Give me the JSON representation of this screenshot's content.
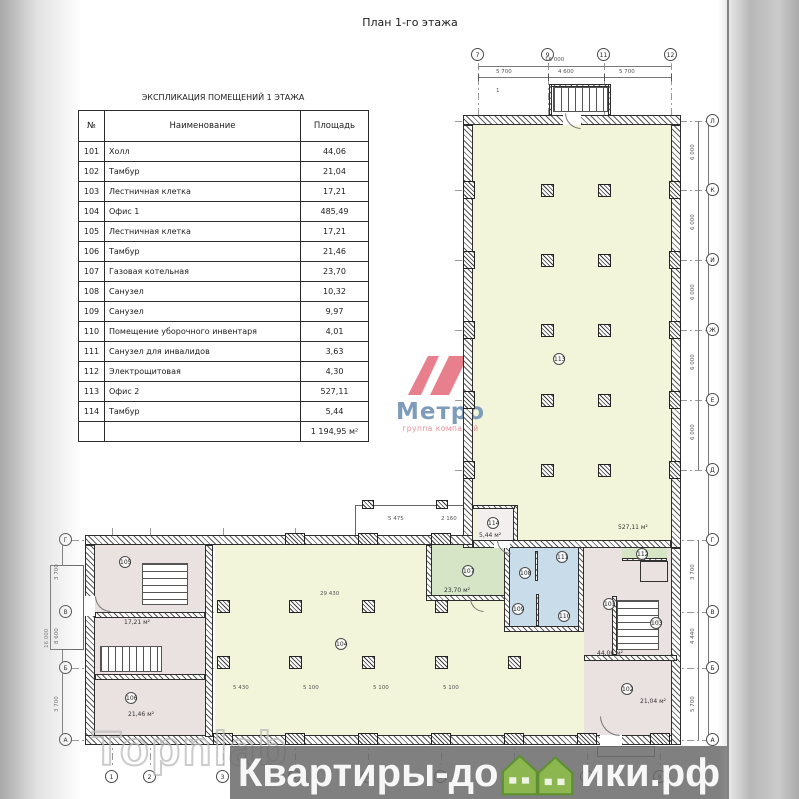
{
  "page": {
    "title": "План 1-го этажа"
  },
  "table": {
    "title": "ЭКСПЛИКАЦИЯ ПОМЕЩЕНИЙ 1 ЭТАЖА",
    "columns": [
      "№",
      "Наименование",
      "Площадь"
    ],
    "rows": [
      [
        "101",
        "Холл",
        "44,06"
      ],
      [
        "102",
        "Тамбур",
        "21,04"
      ],
      [
        "103",
        "Лестничная клетка",
        "17,21"
      ],
      [
        "104",
        "Офис 1",
        "485,49"
      ],
      [
        "105",
        "Лестничная клетка",
        "17,21"
      ],
      [
        "106",
        "Тамбур",
        "21,46"
      ],
      [
        "107",
        "Газовая котельная",
        "23,70"
      ],
      [
        "108",
        "Санузел",
        "10,32"
      ],
      [
        "109",
        "Санузел",
        "9,97"
      ],
      [
        "110",
        "Помещение уборочного инвентаря",
        "4,01"
      ],
      [
        "111",
        "Санузел для инвалидов",
        "3,63"
      ],
      [
        "112",
        "Электрощитовая",
        "4,30"
      ],
      [
        "113",
        "Офис 2",
        "527,11"
      ],
      [
        "114",
        "Тамбур",
        "5,44"
      ]
    ],
    "total": "1 194,95 м²"
  },
  "logo": {
    "name": "Метро",
    "subtitle": "группа компаний",
    "colors": {
      "mark": "#e87f8d",
      "name": "#7e9cba",
      "subtitle": "#e8909b"
    }
  },
  "watermarks": {
    "topnlab": "Topnlab",
    "banner_left": "Квартиры-до",
    "banner_right": "ики.рф",
    "banner_house_color": "#8cb750"
  },
  "plan": {
    "colors": {
      "office": "#f3f5da",
      "wet": "#c9dcea",
      "boiler": "#d7e5c7",
      "circulation": "#eae1e1"
    },
    "walls": [
      [
        463,
        115,
        218,
        10
      ],
      [
        463,
        125,
        10,
        423
      ],
      [
        671,
        125,
        10,
        423
      ],
      [
        85,
        535,
        388,
        10
      ],
      [
        85,
        545,
        10,
        200
      ],
      [
        85,
        735,
        596,
        10
      ],
      [
        671,
        548,
        10,
        197
      ],
      [
        205,
        545,
        8,
        192
      ],
      [
        95,
        612,
        110,
        6
      ],
      [
        95,
        674,
        110,
        6
      ],
      [
        426,
        545,
        6,
        56
      ],
      [
        426,
        595,
        82,
        6
      ],
      [
        504,
        545,
        6,
        87
      ],
      [
        504,
        626,
        80,
        6
      ],
      [
        578,
        545,
        6,
        87
      ],
      [
        584,
        655,
        93,
        6
      ],
      [
        612,
        596,
        5,
        59
      ],
      [
        513,
        505,
        5,
        40
      ],
      [
        473,
        505,
        42,
        4
      ],
      [
        549,
        84,
        62,
        3
      ],
      [
        549,
        84,
        3,
        31
      ],
      [
        608,
        84,
        3,
        31
      ],
      [
        473,
        540,
        198,
        8
      ],
      [
        535,
        551,
        3,
        30
      ],
      [
        622,
        558,
        45,
        3
      ],
      [
        536,
        594,
        3,
        32
      ]
    ],
    "outlines": [
      [
        50,
        565,
        34,
        85
      ],
      [
        355,
        505,
        118,
        37
      ],
      [
        597,
        746,
        58,
        11
      ]
    ],
    "fills": [
      {
        "c": "fy",
        "r": [
          473,
          125,
          198,
          417
        ]
      },
      {
        "c": "fy",
        "r": [
          215,
          545,
          370,
          190
        ]
      },
      {
        "c": "fg",
        "r": [
          432,
          545,
          72,
          52
        ]
      },
      {
        "c": "fb",
        "r": [
          510,
          545,
          68,
          81
        ]
      },
      {
        "c": "fp",
        "r": [
          95,
          545,
          110,
          190
        ]
      },
      {
        "c": "fp",
        "r": [
          584,
          548,
          87,
          107
        ]
      },
      {
        "c": "fp",
        "r": [
          584,
          661,
          87,
          74
        ]
      },
      {
        "c": "fg",
        "r": [
          622,
          548,
          45,
          12
        ]
      },
      {
        "c": "fw",
        "r": [
          477,
          509,
          36,
          31
        ]
      }
    ],
    "stairs": [
      {
        "c": "stv",
        "r": [
          553,
          87,
          55,
          25
        ]
      },
      {
        "c": "sth",
        "r": [
          142,
          563,
          46,
          42
        ]
      },
      {
        "c": "stv",
        "r": [
          100,
          646,
          62,
          26
        ]
      },
      {
        "c": "sth",
        "r": [
          617,
          600,
          42,
          50
        ]
      }
    ],
    "elevator": [
      640,
      561,
      28,
      21
    ],
    "columns": [
      [
        541,
        184,
        13,
        13
      ],
      [
        598,
        184,
        13,
        13
      ],
      [
        541,
        254,
        13,
        13
      ],
      [
        598,
        254,
        13,
        13
      ],
      [
        541,
        324,
        13,
        13
      ],
      [
        598,
        324,
        13,
        13
      ],
      [
        541,
        394,
        13,
        13
      ],
      [
        598,
        394,
        13,
        13
      ],
      [
        541,
        464,
        13,
        13
      ],
      [
        598,
        464,
        13,
        13
      ],
      [
        217,
        600,
        13,
        13
      ],
      [
        289,
        600,
        13,
        13
      ],
      [
        362,
        600,
        13,
        13
      ],
      [
        435,
        600,
        13,
        13
      ],
      [
        217,
        656,
        13,
        13
      ],
      [
        289,
        656,
        13,
        13
      ],
      [
        362,
        656,
        13,
        13
      ],
      [
        435,
        656,
        13,
        13
      ],
      [
        508,
        656,
        13,
        13
      ],
      [
        362,
        500,
        12,
        9
      ],
      [
        436,
        500,
        12,
        9
      ]
    ],
    "pilasters": [
      [
        463,
        181,
        12,
        18
      ],
      [
        463,
        251,
        12,
        18
      ],
      [
        463,
        321,
        12,
        18
      ],
      [
        463,
        391,
        12,
        18
      ],
      [
        463,
        461,
        12,
        18
      ],
      [
        669,
        181,
        12,
        18
      ],
      [
        669,
        251,
        12,
        18
      ],
      [
        669,
        321,
        12,
        18
      ],
      [
        669,
        391,
        12,
        18
      ],
      [
        669,
        461,
        12,
        18
      ],
      [
        213,
        733,
        20,
        12
      ],
      [
        285,
        733,
        20,
        12
      ],
      [
        358,
        733,
        20,
        12
      ],
      [
        431,
        733,
        20,
        12
      ],
      [
        504,
        733,
        20,
        12
      ],
      [
        577,
        733,
        20,
        12
      ],
      [
        650,
        733,
        20,
        12
      ],
      [
        285,
        533,
        20,
        12
      ],
      [
        358,
        533,
        20,
        12
      ],
      [
        431,
        533,
        20,
        12
      ]
    ],
    "gaps": [
      [
        563,
        115,
        18,
        10
      ],
      [
        85,
        596,
        10,
        20
      ],
      [
        600,
        735,
        22,
        10
      ],
      [
        494,
        541,
        16,
        7
      ]
    ],
    "arcs": [
      [
        565,
        113,
        16,
        16
      ],
      [
        497,
        540,
        14,
        14
      ],
      [
        95,
        596,
        16,
        16
      ],
      [
        600,
        716,
        20,
        20
      ],
      [
        470,
        598,
        14,
        14
      ]
    ],
    "grid_v": [
      [
        478,
        48,
        512
      ],
      [
        548,
        48,
        512
      ],
      [
        604,
        48,
        512
      ],
      [
        671,
        48,
        512
      ],
      [
        112,
        528,
        240
      ],
      [
        150,
        528,
        240
      ],
      [
        223,
        528,
        240
      ],
      [
        295,
        528,
        240
      ],
      [
        368,
        528,
        240
      ],
      [
        441,
        528,
        240
      ],
      [
        514,
        528,
        240
      ],
      [
        587,
        528,
        240
      ],
      [
        660,
        528,
        240
      ]
    ],
    "grid_h": [
      [
        455,
        121,
        253
      ],
      [
        455,
        190,
        253
      ],
      [
        455,
        260,
        253
      ],
      [
        455,
        330,
        253
      ],
      [
        455,
        400,
        253
      ],
      [
        455,
        470,
        253
      ],
      [
        72,
        540,
        636
      ],
      [
        72,
        612,
        636
      ],
      [
        72,
        668,
        636
      ],
      [
        72,
        740,
        636
      ]
    ],
    "dim_h": [
      [
        478,
        66,
        193
      ],
      [
        478,
        77,
        193
      ]
    ],
    "dim_v": [
      [
        698,
        121,
        1,
        349
      ],
      [
        698,
        540,
        1,
        200
      ],
      [
        62,
        540,
        1,
        200
      ],
      [
        708,
        121,
        1,
        619
      ]
    ],
    "ticks": [
      [
        478,
        74
      ],
      [
        548,
        74
      ],
      [
        604,
        74
      ],
      [
        671,
        74
      ]
    ],
    "grid_bubbles": [
      {
        "t": "7",
        "x": 471,
        "y": 48
      },
      {
        "t": "9",
        "x": 541,
        "y": 48
      },
      {
        "t": "11",
        "x": 597,
        "y": 48
      },
      {
        "t": "12",
        "x": 664,
        "y": 48
      },
      {
        "t": "1",
        "x": 105,
        "y": 770
      },
      {
        "t": "2",
        "x": 143,
        "y": 770
      },
      {
        "t": "3",
        "x": 216,
        "y": 770
      },
      {
        "t": "4",
        "x": 288,
        "y": 770
      },
      {
        "t": "5",
        "x": 361,
        "y": 770
      },
      {
        "t": "6",
        "x": 434,
        "y": 770
      },
      {
        "t": "7",
        "x": 507,
        "y": 770
      },
      {
        "t": "8",
        "x": 580,
        "y": 770
      },
      {
        "t": "9",
        "x": 653,
        "y": 770
      },
      {
        "t": "Л",
        "x": 706,
        "y": 114
      },
      {
        "t": "К",
        "x": 706,
        "y": 183
      },
      {
        "t": "И",
        "x": 706,
        "y": 253
      },
      {
        "t": "Ж",
        "x": 706,
        "y": 323
      },
      {
        "t": "Е",
        "x": 706,
        "y": 393
      },
      {
        "t": "Д",
        "x": 706,
        "y": 463
      },
      {
        "t": "Г",
        "x": 706,
        "y": 533
      },
      {
        "t": "В",
        "x": 706,
        "y": 605
      },
      {
        "t": "Б",
        "x": 706,
        "y": 661
      },
      {
        "t": "А",
        "x": 706,
        "y": 733
      },
      {
        "t": "Г",
        "x": 59,
        "y": 533
      },
      {
        "t": "В",
        "x": 59,
        "y": 605
      },
      {
        "t": "Б",
        "x": 59,
        "y": 661
      },
      {
        "t": "А",
        "x": 59,
        "y": 733
      }
    ],
    "room_bubbles": [
      {
        "t": "101",
        "x": 603,
        "y": 598
      },
      {
        "t": "102",
        "x": 621,
        "y": 683
      },
      {
        "t": "103",
        "x": 650,
        "y": 617
      },
      {
        "t": "104",
        "x": 335,
        "y": 638
      },
      {
        "t": "105",
        "x": 119,
        "y": 556
      },
      {
        "t": "106",
        "x": 125,
        "y": 692
      },
      {
        "t": "107",
        "x": 462,
        "y": 565
      },
      {
        "t": "108",
        "x": 519,
        "y": 567
      },
      {
        "t": "109",
        "x": 512,
        "y": 603
      },
      {
        "t": "110",
        "x": 558,
        "y": 610
      },
      {
        "t": "111",
        "x": 556,
        "y": 551
      },
      {
        "t": "112",
        "x": 636,
        "y": 548
      },
      {
        "t": "113",
        "x": 553,
        "y": 353
      },
      {
        "t": "114",
        "x": 487,
        "y": 517
      }
    ],
    "area_labels": [
      {
        "t": "23,70 м²",
        "x": 444,
        "y": 587
      },
      {
        "t": "527,11 м²",
        "x": 618,
        "y": 524
      },
      {
        "t": "21,46 м²",
        "x": 128,
        "y": 711
      },
      {
        "t": "17,21 м²",
        "x": 124,
        "y": 619
      },
      {
        "t": "21,04 м²",
        "x": 640,
        "y": 698
      },
      {
        "t": "44,06 м²",
        "x": 597,
        "y": 650
      },
      {
        "t": "5,44 м²",
        "x": 479,
        "y": 532
      }
    ],
    "dim_labels": [
      {
        "t": "16 000",
        "x": 545,
        "y": 57
      },
      {
        "t": "5 700",
        "x": 496,
        "y": 69
      },
      {
        "t": "4 600",
        "x": 558,
        "y": 69
      },
      {
        "t": "5 700",
        "x": 619,
        "y": 69
      },
      {
        "t": "29 430",
        "x": 320,
        "y": 591
      },
      {
        "t": "5 475",
        "x": 388,
        "y": 516
      },
      {
        "t": "2 160",
        "x": 441,
        "y": 516
      },
      {
        "t": "5 430",
        "x": 233,
        "y": 685
      },
      {
        "t": "5 100",
        "x": 303,
        "y": 685
      },
      {
        "t": "5 100",
        "x": 373,
        "y": 685
      },
      {
        "t": "5 100",
        "x": 443,
        "y": 685
      },
      {
        "t": "1",
        "x": 496,
        "y": 88
      }
    ],
    "dim_labels_rot": [
      {
        "t": "6 000",
        "x": 690,
        "y": 160
      },
      {
        "t": "6 000",
        "x": 690,
        "y": 230
      },
      {
        "t": "6 000",
        "x": 690,
        "y": 300
      },
      {
        "t": "6 000",
        "x": 690,
        "y": 370
      },
      {
        "t": "6 000",
        "x": 690,
        "y": 440
      },
      {
        "t": "3 700",
        "x": 690,
        "y": 580
      },
      {
        "t": "4 440",
        "x": 690,
        "y": 644
      },
      {
        "t": "5 700",
        "x": 690,
        "y": 712
      },
      {
        "t": "3 700",
        "x": 54,
        "y": 580
      },
      {
        "t": "8 600",
        "x": 54,
        "y": 644
      },
      {
        "t": "3 700",
        "x": 54,
        "y": 712
      },
      {
        "t": "16 000",
        "x": 44,
        "y": 648
      }
    ]
  }
}
